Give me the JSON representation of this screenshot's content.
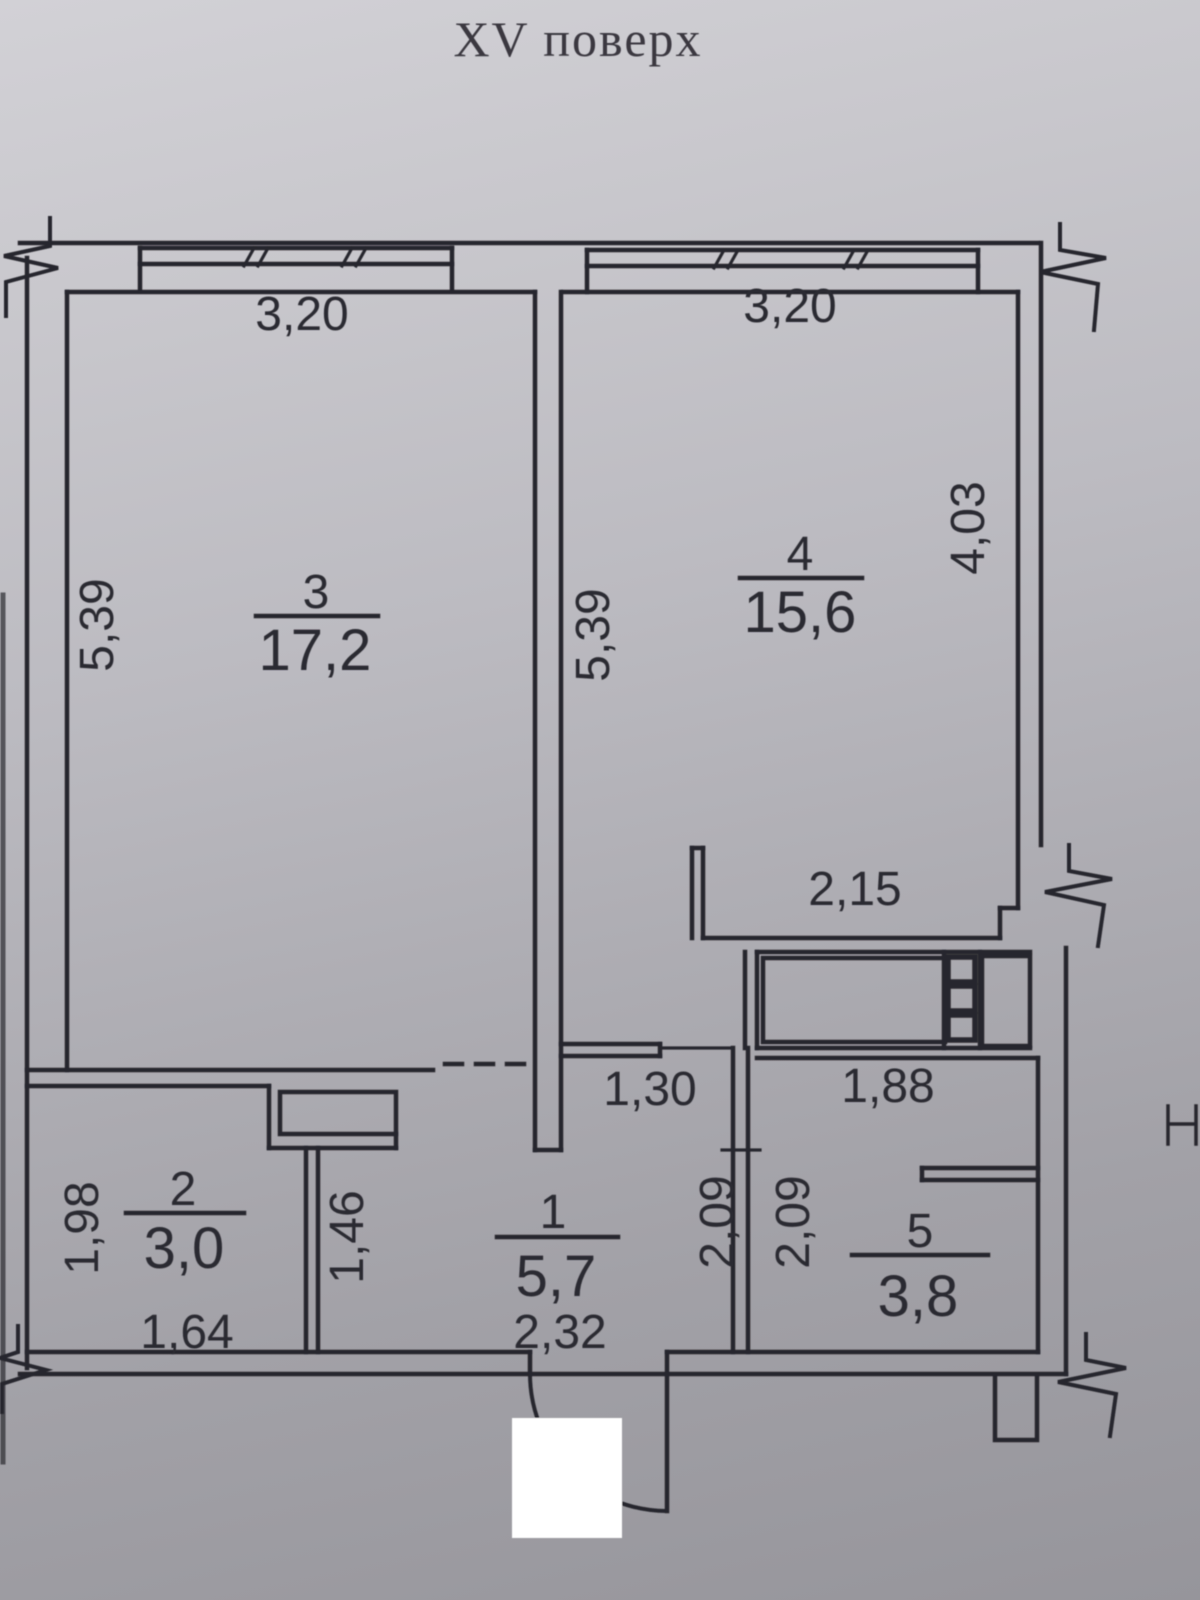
{
  "title": "XV поверх",
  "colors": {
    "paper_top": "#cdccd1",
    "paper_bottom": "#97969b",
    "ink": "#28272d",
    "text": "#2b2a30",
    "whiteout": "#ffffff"
  },
  "plan": {
    "rooms": [
      {
        "id": "room-1",
        "number": "1",
        "area": "5,7"
      },
      {
        "id": "room-2",
        "number": "2",
        "area": "3,0"
      },
      {
        "id": "room-3",
        "number": "3",
        "area": "17,2"
      },
      {
        "id": "room-4",
        "number": "4",
        "area": "15,6"
      },
      {
        "id": "room-5",
        "number": "5",
        "area": "3,8"
      }
    ],
    "dimensions": {
      "room3_width_top": "3,20",
      "room4_width_top": "3,20",
      "room3_depth_left": "5,39",
      "room4_depth_middle": "5,39",
      "room4_depth_right": "4,03",
      "niche_width": "2,15",
      "hall_opening_width": "1,30",
      "room5_width": "1,88",
      "hall_depth": "2,09",
      "room5_depth": "2,09",
      "room2_depth": "1,98",
      "partition_length": "1,46",
      "room2_width": "1,64",
      "hall_width": "2,32"
    }
  }
}
